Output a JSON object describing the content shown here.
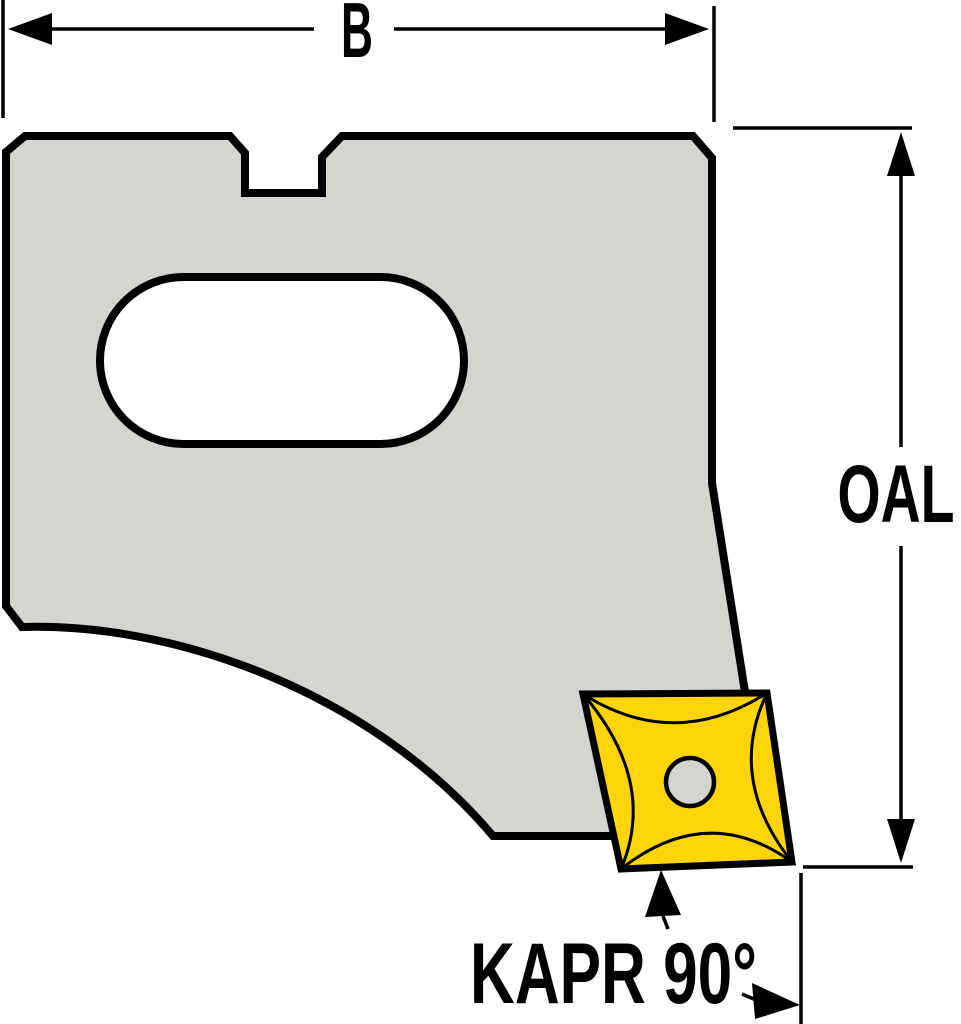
{
  "figure": {
    "labels": {
      "width": "B",
      "overall_length": "OAL",
      "entering_angle": "KAPR 90°"
    },
    "colors": {
      "background": "#ffffff",
      "outline": "#000000",
      "body_fill": "#d3d5d1",
      "slot_fill": "#ffffff",
      "insert_fill": "#ffd408",
      "insert_hole_fill": "#d3d5d1"
    }
  }
}
